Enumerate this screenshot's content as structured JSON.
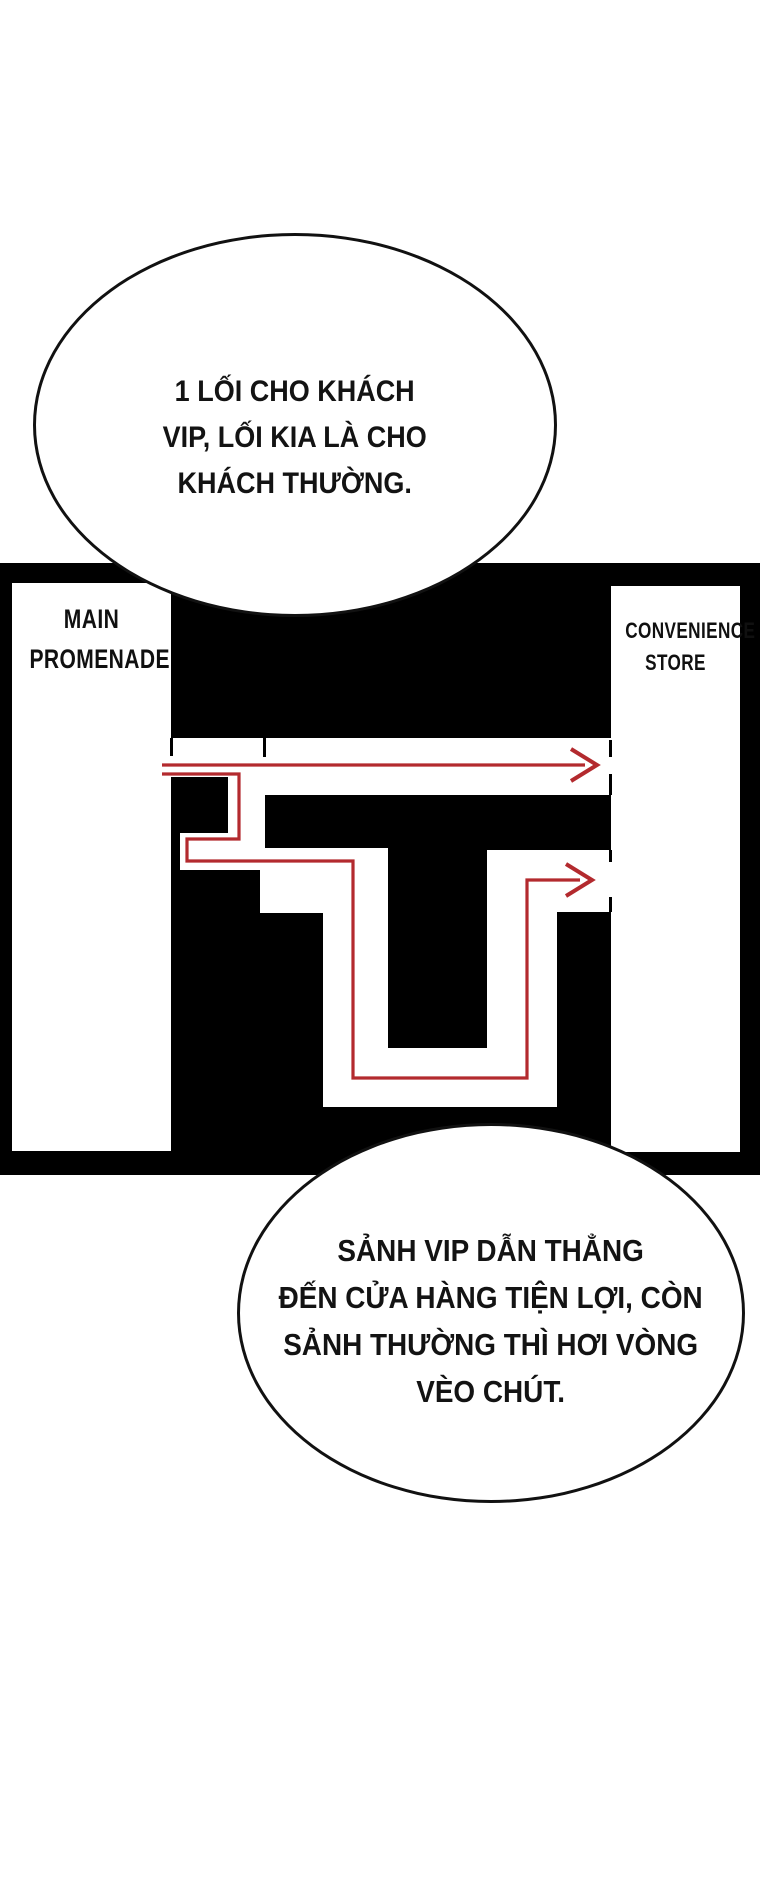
{
  "colors": {
    "panel_black": "#000000",
    "route_red": "#b32a2e",
    "ink": "#131313"
  },
  "plan": {
    "left_room_label": [
      "MAIN",
      "PROMENADE"
    ],
    "right_room_label": [
      "CONVENIENCE",
      "STORE"
    ]
  },
  "bubbles": {
    "top": {
      "lines": [
        "1 LỐI CHO KHÁCH",
        "VIP, LỐI KIA LÀ CHO",
        "KHÁCH THƯỜNG."
      ]
    },
    "bottom": {
      "lines": [
        "SẢNH VIP DẪN THẲNG",
        "ĐẾN CỬA HÀNG TIỆN LỢI, CÒN",
        "SẢNH THƯỜNG THÌ HƠI VÒNG",
        "VÈO CHÚT."
      ]
    }
  }
}
